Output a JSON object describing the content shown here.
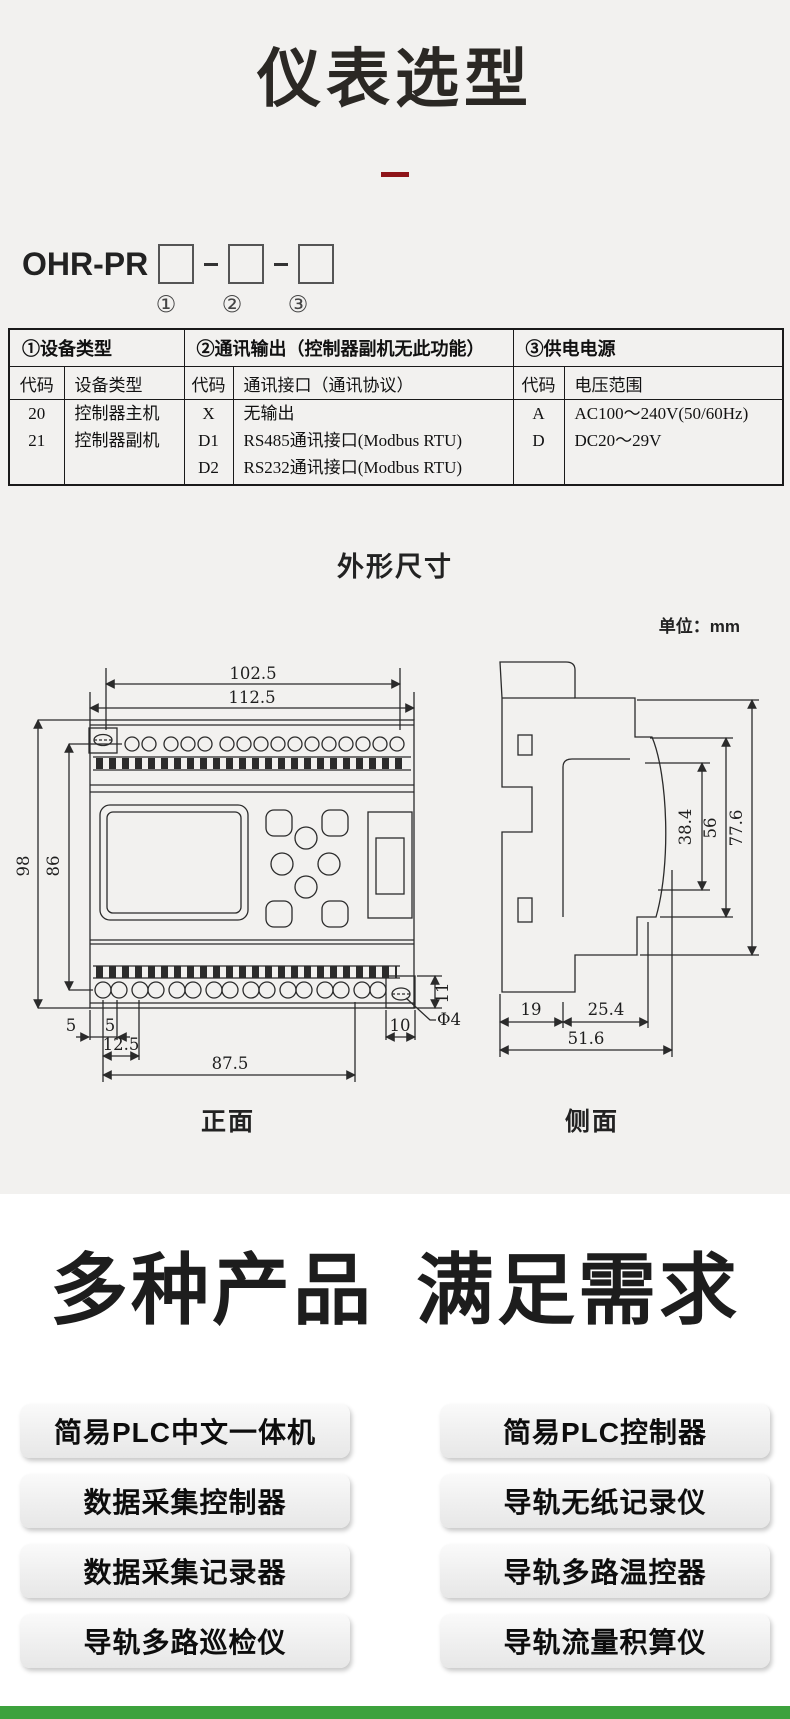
{
  "page": {
    "title": "仪表选型",
    "dimensions_title": "外形尺寸",
    "unit_label": "单位：mm",
    "front_label": "正面",
    "side_label": "侧面",
    "products_heading_1": "多种产品",
    "products_heading_2": "满足需求"
  },
  "model": {
    "prefix": "OHR-PR",
    "markers": [
      "①",
      "②",
      "③"
    ]
  },
  "selection_table": {
    "groups": [
      {
        "title": "①设备类型",
        "code_header": "代码",
        "value_header": "设备类型",
        "rows": [
          {
            "code": "20",
            "value": "控制器主机"
          },
          {
            "code": "21",
            "value": "控制器副机"
          }
        ]
      },
      {
        "title": "②通讯输出（控制器副机无此功能）",
        "code_header": "代码",
        "value_header": "通讯接口（通讯协议）",
        "rows": [
          {
            "code": "X",
            "value": "无输出"
          },
          {
            "code": "D1",
            "value": "RS485通讯接口(Modbus RTU)"
          },
          {
            "code": "D2",
            "value": "RS232通讯接口(Modbus RTU)"
          }
        ]
      },
      {
        "title": "③供电电源",
        "code_header": "代码",
        "value_header": "电压范围",
        "rows": [
          {
            "code": "A",
            "value": "AC100～240V(50/60Hz)"
          },
          {
            "code": "D",
            "value": "DC20～29V"
          }
        ]
      }
    ]
  },
  "front_view_dims": {
    "inner_width": "102.5",
    "outer_width": "112.5",
    "outer_height": "98",
    "inner_height": "86",
    "offset_a": "5",
    "offset_b": "5",
    "offset_c": "12.5",
    "terminal_span": "87.5",
    "hole_offset": "10",
    "hole_height": "11",
    "hole_dia": "Φ4"
  },
  "side_view_dims": {
    "height_inner": "38.4",
    "height_mid": "56",
    "height_total": "77.6",
    "depth_a": "19",
    "depth_b": "25.4",
    "depth_total": "51.6"
  },
  "products": {
    "left": [
      "简易PLC中文一体机",
      "数据采集控制器",
      "数据采集记录器",
      "导轨多路巡检仪"
    ],
    "right": [
      "简易PLC控制器",
      "导轨无纸记录仪",
      "导轨多路温控器",
      "导轨流量积算仪"
    ]
  },
  "colors": {
    "accent_red": "#8e1418",
    "drawing_line": "#2b2b2b",
    "section_bg": "#f2f1ef",
    "footer_green": "#3da23d"
  }
}
